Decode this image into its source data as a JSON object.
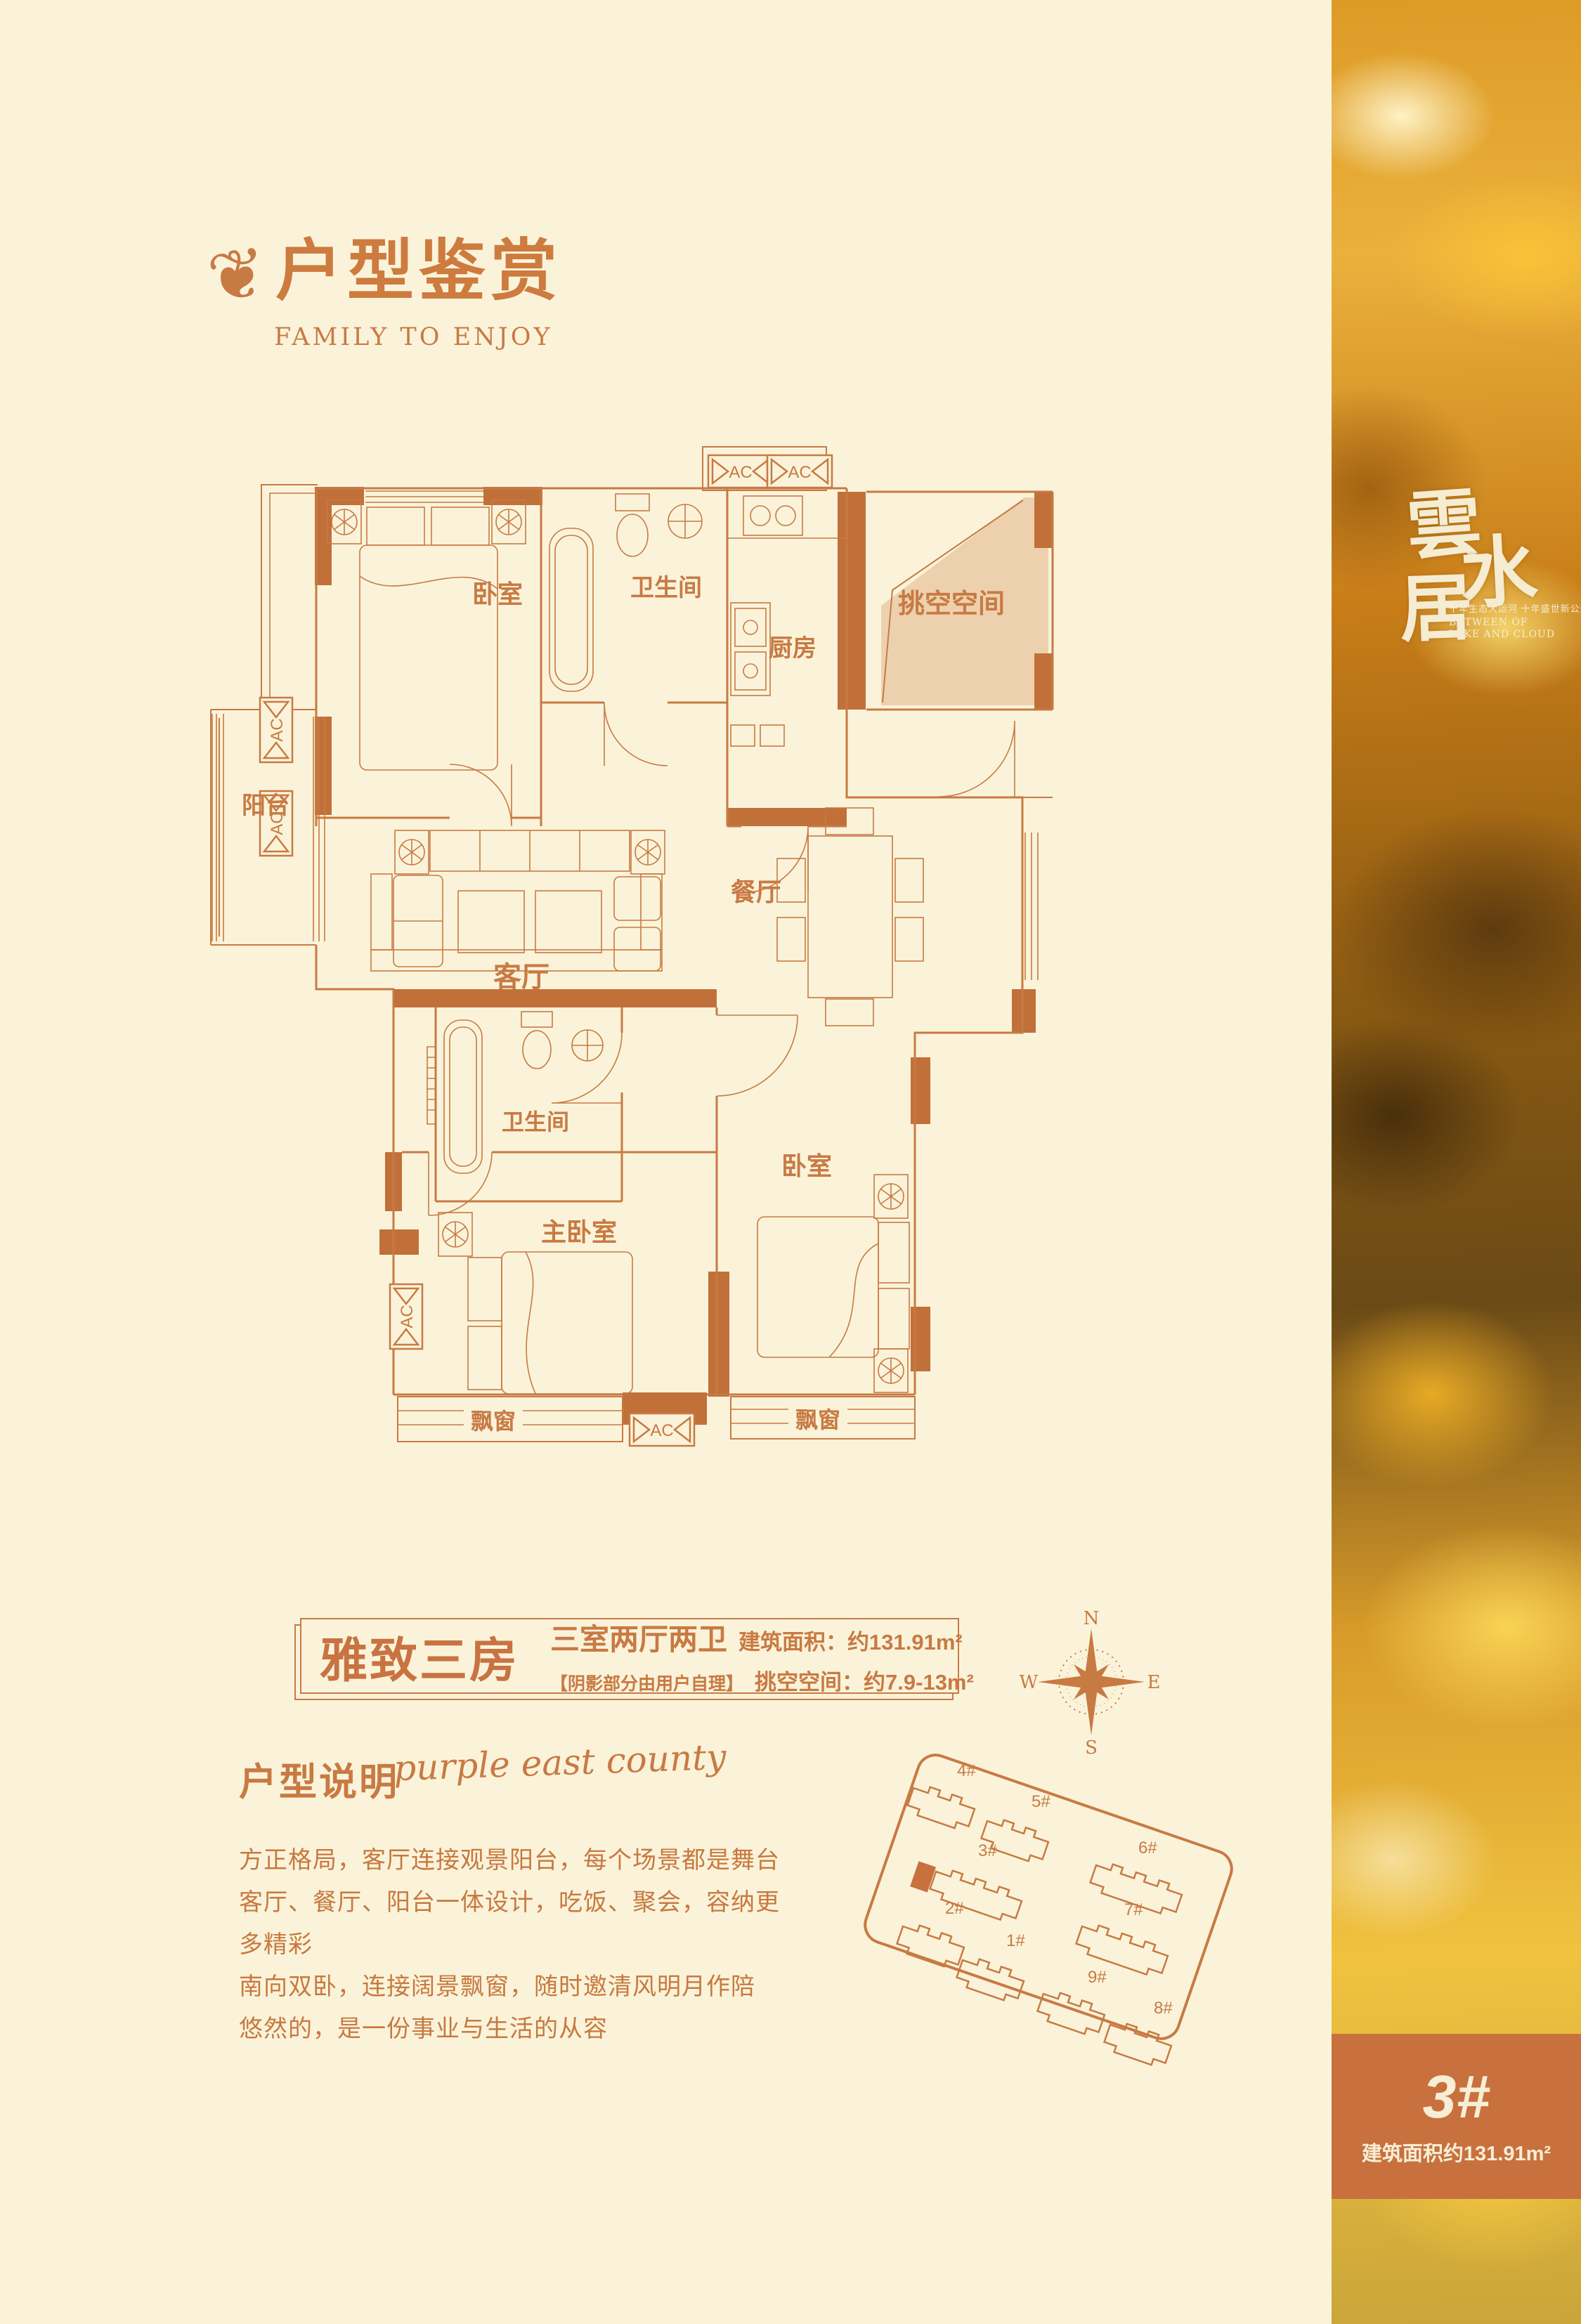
{
  "page": {
    "bg": "#faf3da",
    "accent": "#c87a43",
    "wall": "#c1703a",
    "shade": "#edd1ae"
  },
  "header": {
    "ornament": "❦",
    "title": "户型鉴赏",
    "subtitle": "FAMILY TO ENJOY"
  },
  "floorplan": {
    "labels": {
      "bedroom_top": "卧室",
      "bath_top": "卫生间",
      "kitchen": "厨房",
      "void": "挑空空间",
      "balcony": "阳台",
      "living": "客厅",
      "dining": "餐厅",
      "bath_mid": "卫生间",
      "master": "主卧室",
      "bedroom_right": "卧室",
      "bay_left": "飘窗",
      "bay_right": "飘窗",
      "ac": "AC"
    }
  },
  "info_bar": {
    "name": "雅致三房",
    "layout": "三室两厅两卫",
    "area": "建筑面积：约131.91m²",
    "note": "【阴影部分由用户自理】",
    "void_space": "挑空空间：约7.9-13m²"
  },
  "description": {
    "heading": "户型说明",
    "script": "purple east county",
    "lines": [
      "方正格局，客厅连接观景阳台，每个场景都是舞台",
      "客厅、餐厅、阳台一体设计，吃饭、聚会，容纳更多精彩",
      "南向双卧，连接阔景飘窗，随时邀清风明月作陪",
      "悠然的，是一份事业与生活的从容"
    ]
  },
  "siteplan": {
    "compass": {
      "n": "N",
      "e": "E",
      "s": "S",
      "w": "W"
    },
    "buildings": [
      {
        "id": "4#"
      },
      {
        "id": "5#"
      },
      {
        "id": "3#"
      },
      {
        "id": "6#"
      },
      {
        "id": "2#"
      },
      {
        "id": "1#"
      },
      {
        "id": "7#"
      },
      {
        "id": "9#"
      },
      {
        "id": "8#"
      }
    ]
  },
  "strip": {
    "logo_chars": [
      "雲",
      "水",
      "居"
    ],
    "tagline": "千年生态大运河 十年盛世新公元",
    "tagline_en_1": "BETWEEN OF",
    "tagline_en_2": "LAKE AND CLOUD",
    "badge_building": "3#",
    "badge_area": "建筑面积约131.91m²"
  }
}
